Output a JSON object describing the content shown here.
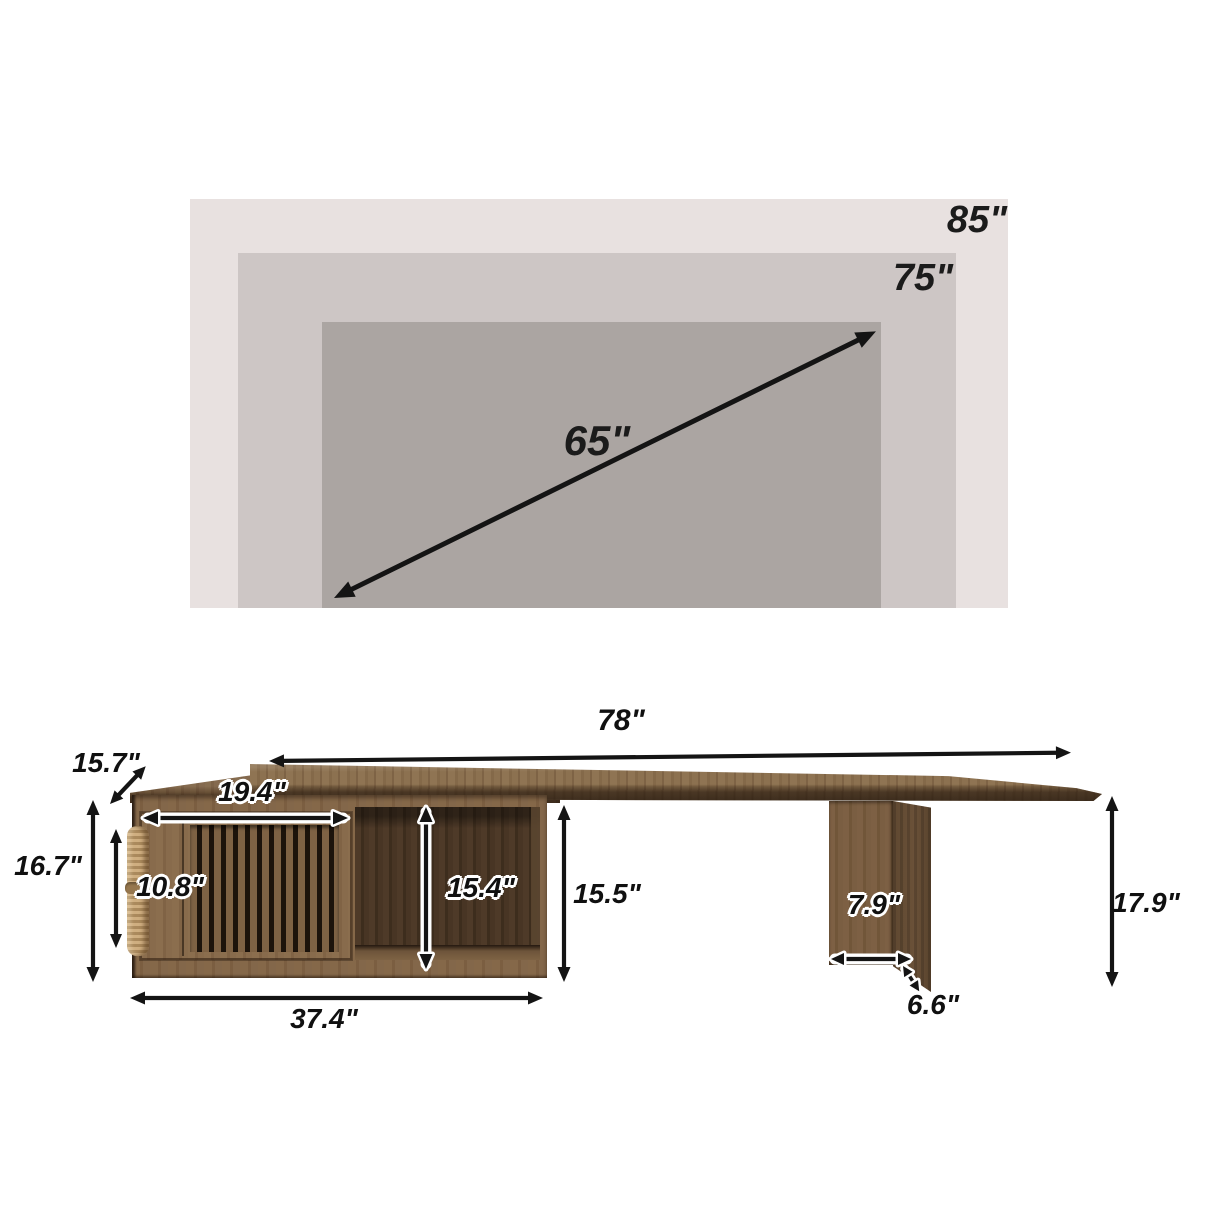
{
  "tv_compat_chart": {
    "sizes": [
      {
        "label": "85\""
      },
      {
        "label": "75\""
      },
      {
        "label": "65\""
      }
    ],
    "rect_colors": [
      "#e8e1e0",
      "#cdc6c5",
      "#aba5a2"
    ]
  },
  "stand_diagram": {
    "dimensions": {
      "tabletop_width": "78\"",
      "tabletop_depth": "15.7\"",
      "cabinet_outer_height": "16.7\"",
      "crate_door_width": "19.4\"",
      "crate_door_height": "10.8\"",
      "open_shelf_height": "15.4\"",
      "cabinet_side_height": "15.5\"",
      "cabinet_width": "37.4\"",
      "leg_width": "7.9\"",
      "leg_foot_depth": "6.6\"",
      "tabletop_floor_height": "17.9\""
    },
    "wood_colors": {
      "top_light": "#8d7252",
      "frame_medium": "#7c5f42",
      "interior_dark": "#4a3727",
      "rope": "#c7a87a"
    }
  }
}
